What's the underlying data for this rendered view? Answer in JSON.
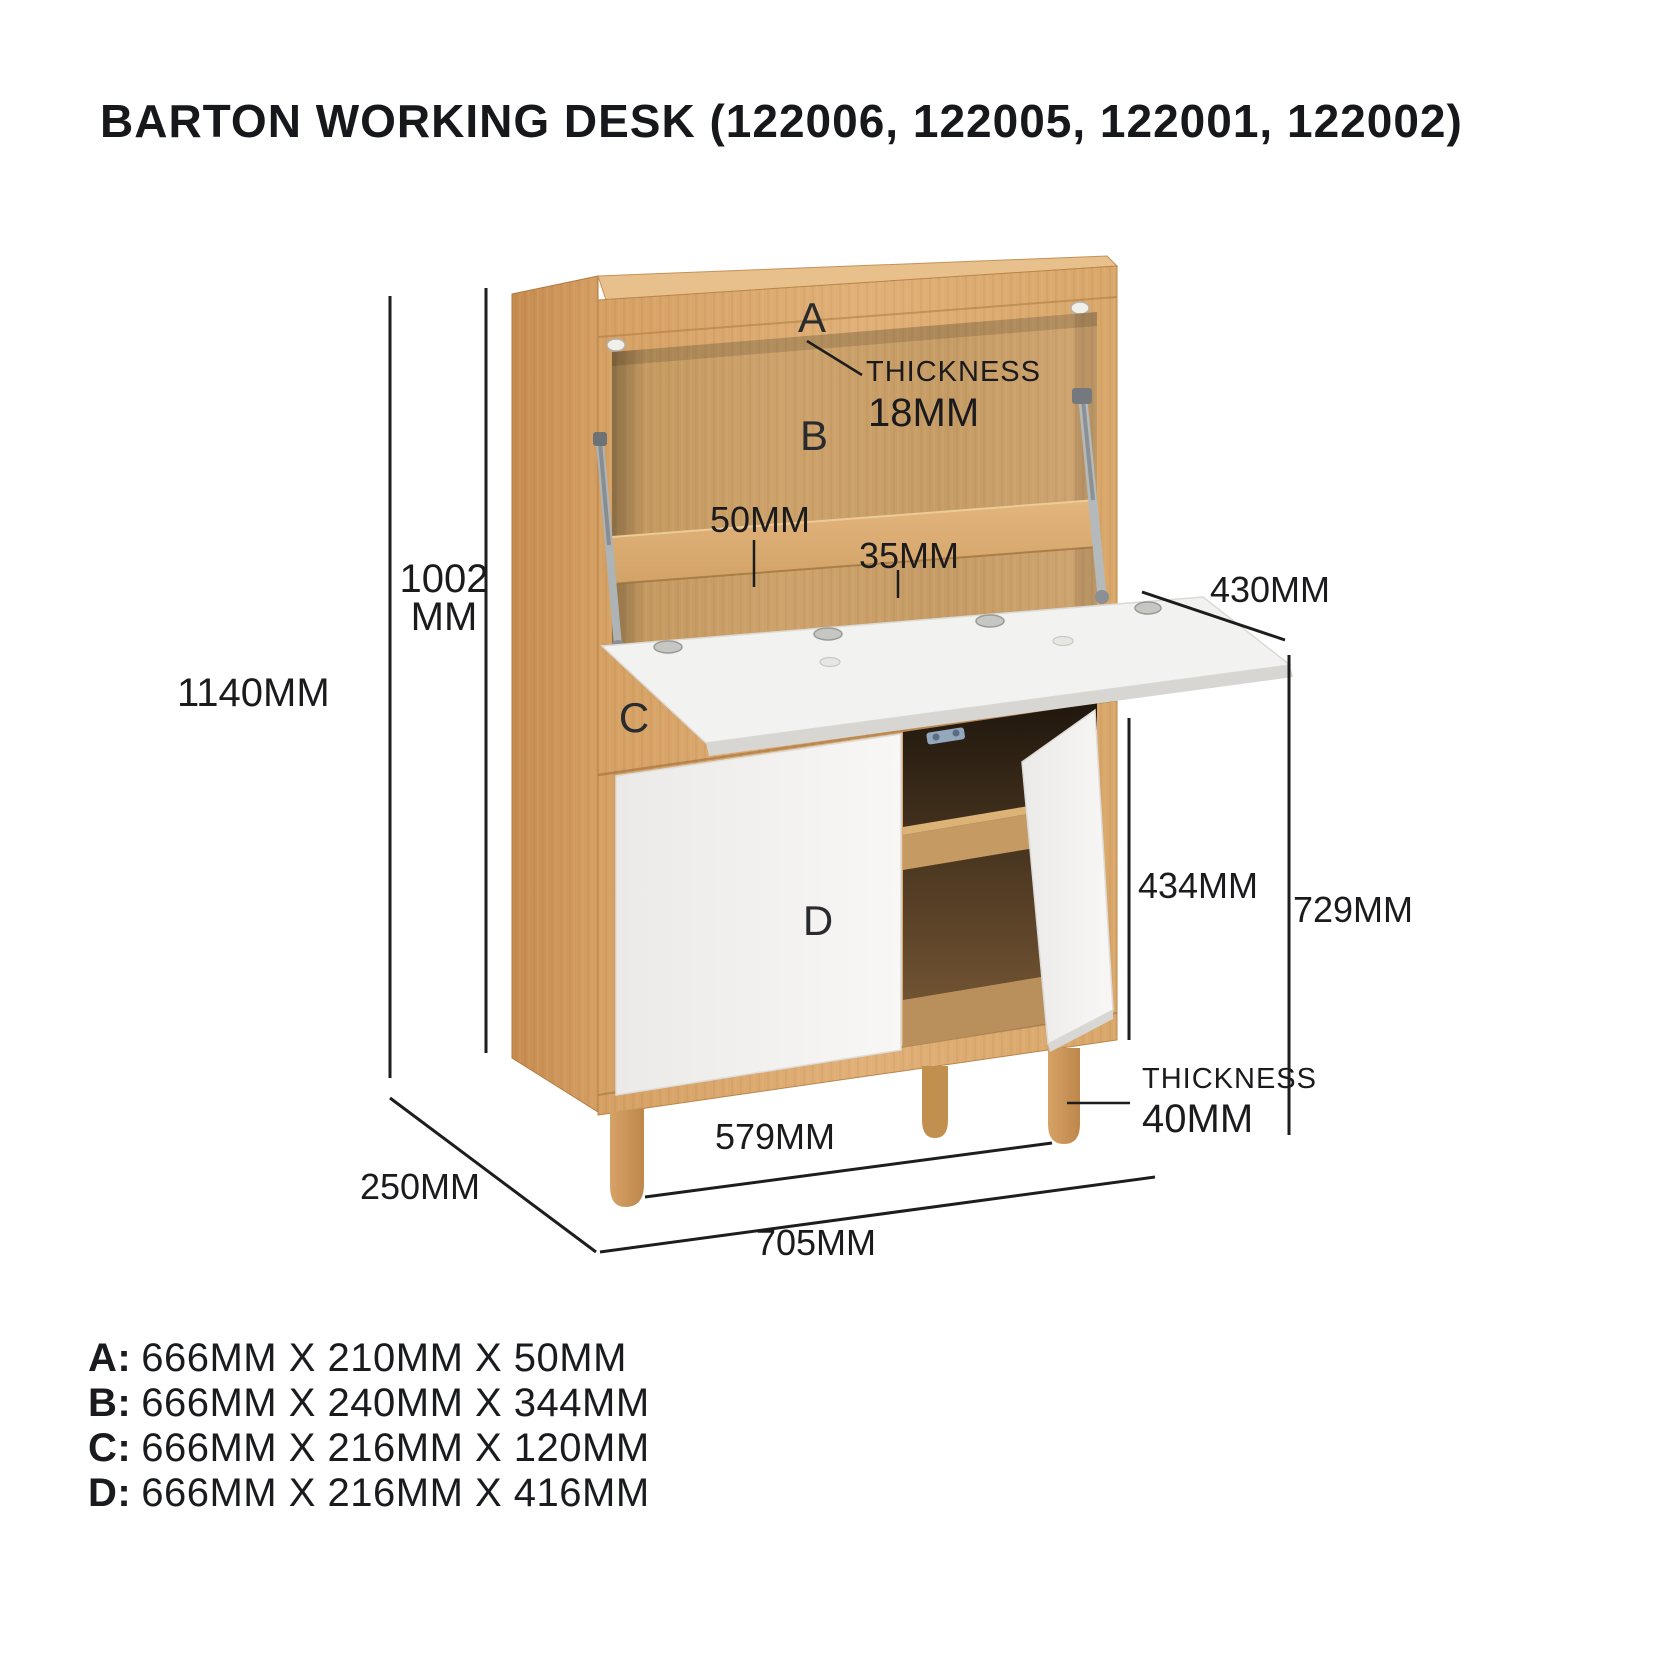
{
  "title": "BARTON WORKING DESK (122006, 122005, 122001, 122002)",
  "diagram": {
    "part_labels": {
      "a": "A",
      "b": "B",
      "c": "C",
      "d": "D"
    },
    "annotations": {
      "shelf_thickness_label": "THICKNESS",
      "shelf_thickness_value": "18MM",
      "rail_height": "50MM",
      "rail_thickness": "35MM",
      "desk_depth": "430MM",
      "upper_height_line1": "1002",
      "upper_height_line2": "MM",
      "total_height": "1140MM",
      "cabinet_depth": "250MM",
      "door_height": "434MM",
      "lower_height": "729MM",
      "leg_thickness_label": "THICKNESS",
      "leg_thickness_value": "40MM",
      "leg_span": "579MM",
      "total_width": "705MM"
    },
    "colors": {
      "wood": "#d9a76c",
      "wood_dark": "#c98f52",
      "panel_white": "#f2f1ef",
      "dimension_line": "#1d1d1f"
    }
  },
  "legend": {
    "items": [
      {
        "label": "A:",
        "dims": "666MM X 210MM X 50MM"
      },
      {
        "label": "B:",
        "dims": "666MM X 240MM X 344MM"
      },
      {
        "label": "C:",
        "dims": "666MM X 216MM X 120MM"
      },
      {
        "label": "D:",
        "dims": "666MM X 216MM X 416MM"
      }
    ]
  }
}
